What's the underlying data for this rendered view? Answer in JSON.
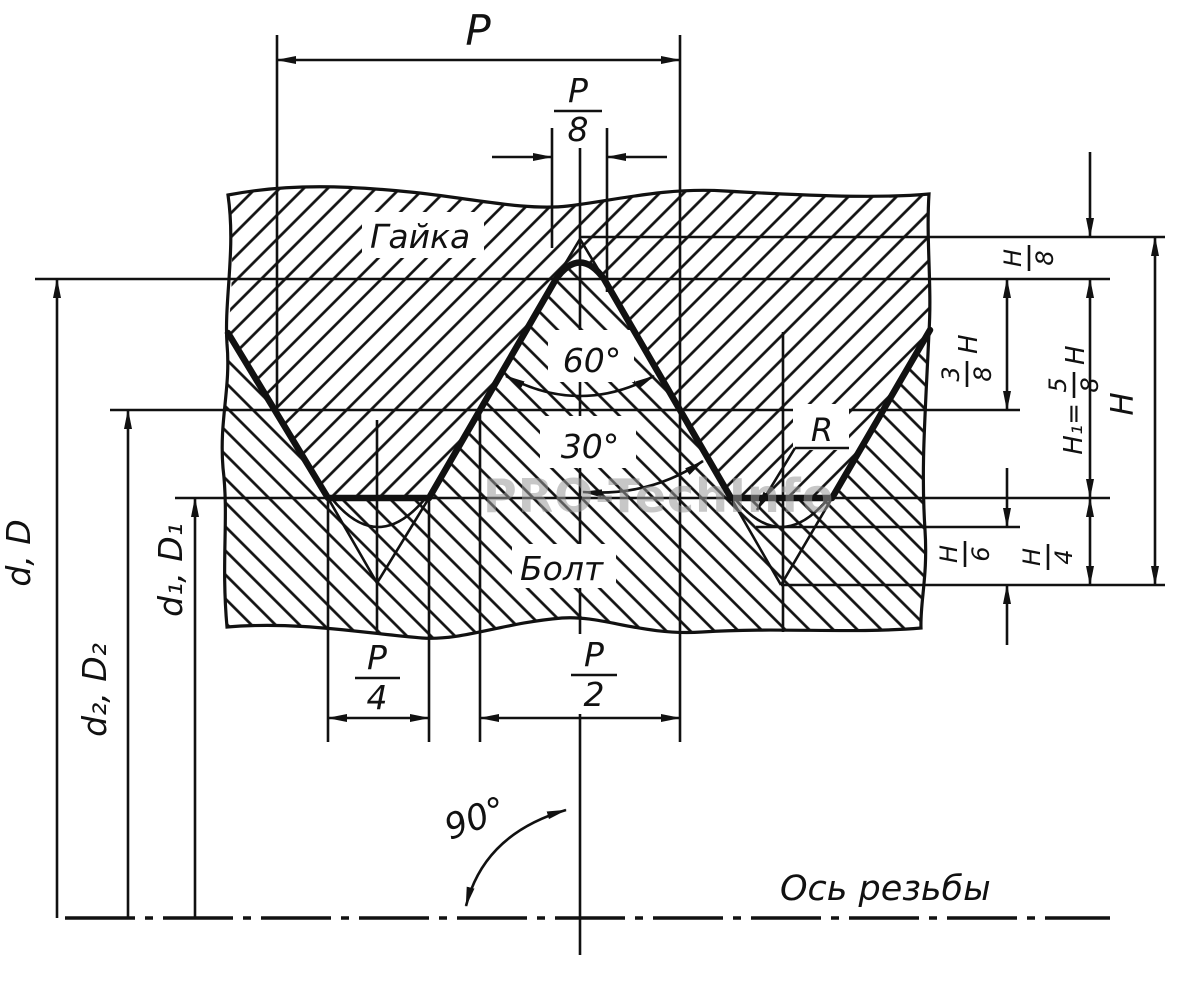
{
  "labels": {
    "pitch": "P",
    "nut": "Гайка",
    "bolt": "Болт",
    "angle_full": "60°",
    "angle_half": "30°",
    "angle_axis": "90°",
    "radius": "R",
    "thread_axis": "Ось резьбы",
    "dia_major": "d, D",
    "dia_pitch": "d₂, D₂",
    "dia_minor": "d₁, D₁",
    "height_total": "H"
  },
  "fractions": {
    "p8": {
      "num": "P",
      "den": "8"
    },
    "p4": {
      "num": "P",
      "den": "4"
    },
    "p2": {
      "num": "P",
      "den": "2"
    },
    "h8": {
      "num": "H",
      "den": "8"
    },
    "h6": {
      "num": "H",
      "den": "6"
    },
    "h4": {
      "num": "H",
      "den": "4"
    },
    "h38": {
      "num": "3",
      "den": "8",
      "suffix": "H"
    },
    "h1": {
      "prefix": "H₁=",
      "num": "5",
      "den": "8",
      "suffix": "H"
    }
  },
  "watermark": "PRO-TechInfo",
  "colors": {
    "ink": "#111111",
    "watermark": "#9a9a9a",
    "background": "#ffffff"
  }
}
